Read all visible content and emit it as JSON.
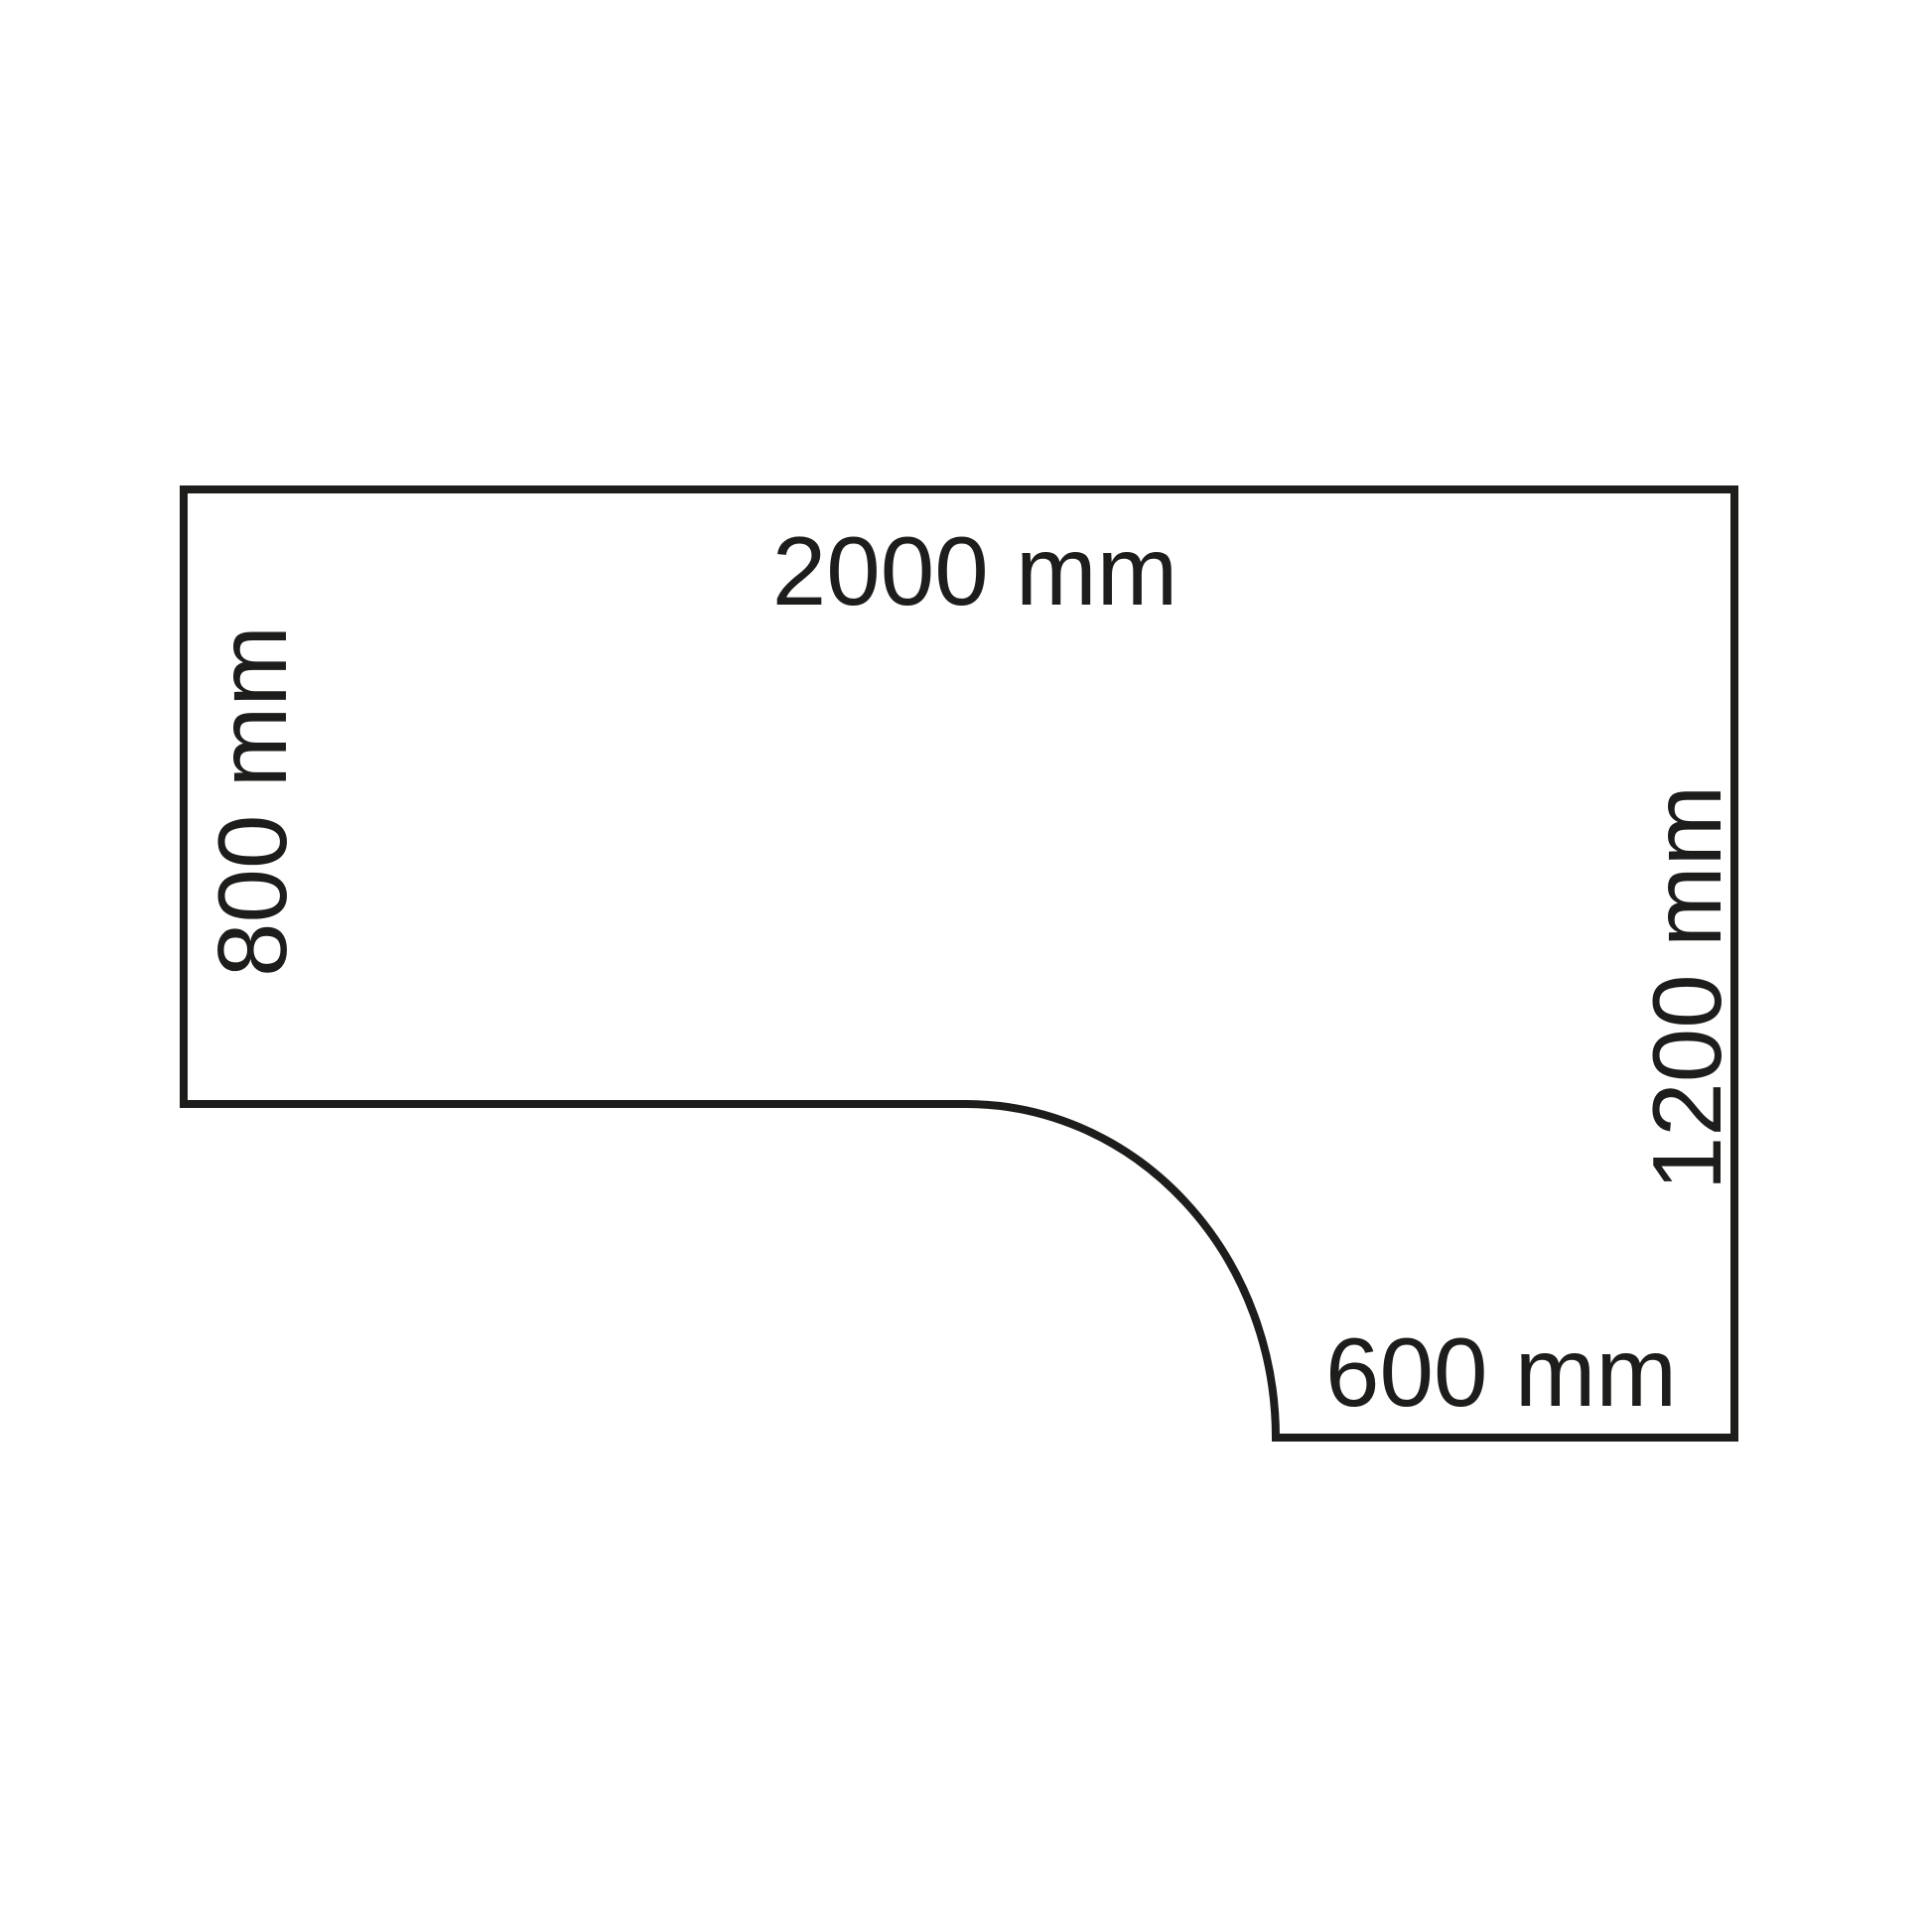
{
  "diagram": {
    "title": "corner-desk-top-dimension-drawing",
    "background_color": "#ffffff",
    "stroke_color": "#1d1d1b",
    "text_color": "#1d1d1b",
    "labels": {
      "top_width": "2000 mm",
      "left_depth": "800 mm",
      "right_depth": "1200 mm",
      "bottom_width": "600 mm"
    }
  }
}
